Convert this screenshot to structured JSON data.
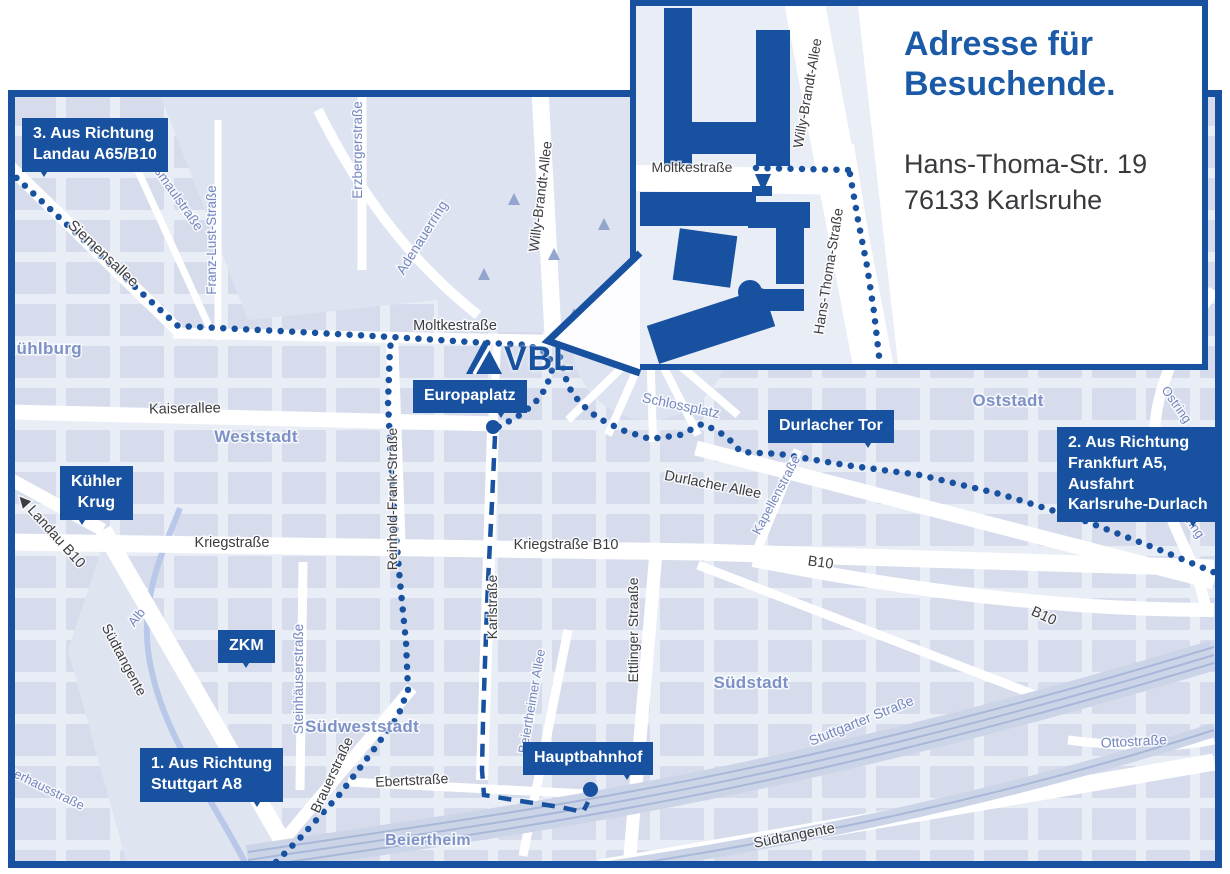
{
  "colors": {
    "primary_blue": "#17519f",
    "map_background": "#e9edf6",
    "block_fill": "#d6dcec",
    "street_white": "#ffffff",
    "label_dark": "#3d3d40",
    "label_blue": "#7488bf",
    "area_label_blue": "#7d91c6",
    "river_blue": "#b9c8e8",
    "rail_gray_blue": "#a9b7d8"
  },
  "logo": {
    "text": "VBL",
    "icon": "vbl-triangle-icon"
  },
  "inset": {
    "title_line1": "Adresse für",
    "title_line2": "Besuchende.",
    "address_line1": "Hans-Thoma-Str. 19",
    "address_line2": "76133 Karlsruhe",
    "street_labels": [
      {
        "text": "Moltkestraße",
        "x": 56,
        "y": 166,
        "r": 0
      },
      {
        "text": "Willy-Brandt-Allee",
        "x": 176,
        "y": 88,
        "r": -80
      },
      {
        "text": "Hans-Thoma-Straße",
        "x": 197,
        "y": 266,
        "r": -81
      }
    ],
    "route_dotted": [
      [
        [
          120,
          162
        ],
        [
          213,
          164
        ]
      ],
      [
        [
          214,
          168
        ],
        [
          222,
          214
        ],
        [
          231,
          260
        ],
        [
          238,
          306
        ],
        [
          243,
          350
        ]
      ]
    ]
  },
  "signs": [
    {
      "id": "landau",
      "x": 22,
      "y": 118,
      "lines": [
        "3. Aus Richtung",
        "Landau A65/B10"
      ],
      "tail": "left"
    },
    {
      "id": "kuehler-krug",
      "x": 60,
      "y": 466,
      "lines": [
        "Kühler",
        "Krug"
      ],
      "tail": "left",
      "align": "center"
    },
    {
      "id": "zkm",
      "x": 218,
      "y": 630,
      "lines": [
        "ZKM"
      ],
      "tail": "center"
    },
    {
      "id": "stuttgart",
      "x": 140,
      "y": 748,
      "lines": [
        "1. Aus Richtung",
        "Stuttgart A8"
      ],
      "tail": "right"
    },
    {
      "id": "europaplatz",
      "x": 413,
      "y": 380,
      "lines": [
        "Europaplatz"
      ],
      "tail": "right",
      "dot": [
        493,
        427
      ]
    },
    {
      "id": "durlacher-tor",
      "x": 768,
      "y": 410,
      "lines": [
        "Durlacher Tor"
      ],
      "tail": "right"
    },
    {
      "id": "frankfurt",
      "x": 1057,
      "y": 427,
      "lines": [
        "2. Aus Richtung",
        "Frankfurt A5,",
        "Ausfahrt",
        "Karlsruhe-Durlach"
      ],
      "tail": "right"
    },
    {
      "id": "hauptbahnhof",
      "x": 523,
      "y": 742,
      "lines": [
        "Hauptbahnhof"
      ],
      "tail": "right",
      "dot": [
        590,
        789
      ]
    }
  ],
  "map": {
    "street_labels": [
      {
        "text": "Siemensallee",
        "x": 92,
        "y": 167,
        "r": 43,
        "c": "dark",
        "s": 15
      },
      {
        "text": "Kußmaulstraße",
        "x": 162,
        "y": 104,
        "r": 55,
        "c": "blue",
        "s": 13.5
      },
      {
        "text": "Franz-Lust-Straße",
        "x": 208,
        "y": 150,
        "r": -90,
        "c": "blue",
        "s": 13.5
      },
      {
        "text": "Erzbergerstraße",
        "x": 354,
        "y": 60,
        "r": -90,
        "c": "blue",
        "s": 13.5
      },
      {
        "text": "Mühlburg",
        "x": 34,
        "y": 264,
        "r": 0,
        "c": "area",
        "s": 17
      },
      {
        "text": "Adenauerring",
        "x": 418,
        "y": 150,
        "r": -58,
        "c": "blue",
        "s": 14
      },
      {
        "text": "Willy-Brandt-Allee",
        "x": 537,
        "y": 107,
        "r": -83,
        "c": "dark",
        "s": 14
      },
      {
        "text": "Moltkestraße",
        "x": 447,
        "y": 240,
        "r": 0,
        "c": "dark",
        "s": 14.5
      },
      {
        "text": "Kaiserallee",
        "x": 177,
        "y": 323,
        "r": -1,
        "c": "dark",
        "s": 14.5
      },
      {
        "text": "Weststadt",
        "x": 248,
        "y": 352,
        "r": 0,
        "c": "area",
        "s": 17
      },
      {
        "text": "Schlossplatz",
        "x": 672,
        "y": 320,
        "r": 12,
        "c": "blue",
        "s": 14
      },
      {
        "text": "Oststadt",
        "x": 1000,
        "y": 316,
        "r": 0,
        "c": "area",
        "s": 17
      },
      {
        "text": "Reinhold-Frank-Straße",
        "x": 389,
        "y": 409,
        "r": -90,
        "c": "dark",
        "s": 14
      },
      {
        "text": "Kriegstraße",
        "x": 224,
        "y": 457,
        "r": 0,
        "c": "dark",
        "s": 14.5
      },
      {
        "text": "Kriegstraße B10",
        "x": 558,
        "y": 459,
        "r": 0,
        "c": "dark",
        "s": 14.5
      },
      {
        "text": "Durlacher Allee",
        "x": 704,
        "y": 399,
        "r": 11,
        "c": "dark",
        "s": 14.5
      },
      {
        "text": "Kapellenstraße",
        "x": 772,
        "y": 407,
        "r": -62,
        "c": "blue",
        "s": 13
      },
      {
        "text": "Ostring",
        "x": 1165,
        "y": 317,
        "r": 55,
        "c": "blue",
        "s": 13
      },
      {
        "text": "Ostring",
        "x": 1178,
        "y": 432,
        "r": 55,
        "c": "blue",
        "s": 13
      },
      {
        "text": "B10",
        "x": 812,
        "y": 477,
        "r": 8,
        "c": "dark",
        "s": 14.5
      },
      {
        "text": "B10",
        "x": 1034,
        "y": 530,
        "r": 25,
        "c": "dark",
        "s": 14.5
      },
      {
        "text": "◀ Landau B10",
        "x": 40,
        "y": 444,
        "r": 48,
        "c": "dark",
        "s": 14.5
      },
      {
        "text": "Karlstraße",
        "x": 489,
        "y": 517,
        "r": -90,
        "c": "dark",
        "s": 14
      },
      {
        "text": "Ettlinger Straaße",
        "x": 630,
        "y": 540,
        "r": -90,
        "c": "dark",
        "s": 14
      },
      {
        "text": "Steinhäuserstraße",
        "x": 295,
        "y": 589,
        "r": -90,
        "c": "blue",
        "s": 13.5
      },
      {
        "text": "Südweststadt",
        "x": 354,
        "y": 642,
        "r": 0,
        "c": "area",
        "s": 17
      },
      {
        "text": "Südstadt",
        "x": 743,
        "y": 598,
        "r": 0,
        "c": "area",
        "s": 17
      },
      {
        "text": "Stuttgarter Straße",
        "x": 855,
        "y": 635,
        "r": -22,
        "c": "blue",
        "s": 14
      },
      {
        "text": "Südtangente",
        "x": 112,
        "y": 572,
        "r": 62,
        "c": "dark",
        "s": 14
      },
      {
        "text": "Südtangente",
        "x": 787,
        "y": 750,
        "r": -11,
        "c": "dark",
        "s": 14.5
      },
      {
        "text": "Alb",
        "x": 132,
        "y": 530,
        "r": -52,
        "c": "blue",
        "s": 13
      },
      {
        "text": "Pulverhausstraße",
        "x": 28,
        "y": 698,
        "r": 26,
        "c": "blue",
        "s": 13
      },
      {
        "text": "Ottostraße",
        "x": 1126,
        "y": 656,
        "r": -3,
        "c": "blue",
        "s": 14
      },
      {
        "text": "Brauerstraße",
        "x": 328,
        "y": 687,
        "r": -65,
        "c": "dark",
        "s": 14
      },
      {
        "text": "Ebertstraße",
        "x": 404,
        "y": 695,
        "r": -3,
        "c": "dark",
        "s": 14
      },
      {
        "text": "Beiertheimer Allee",
        "x": 528,
        "y": 612,
        "r": -80,
        "c": "blue",
        "s": 13
      },
      {
        "text": "Beiertheim",
        "x": 420,
        "y": 755,
        "r": 0,
        "c": "area",
        "s": 16
      }
    ],
    "routes": {
      "dotted": [
        [
          [
            0,
            80
          ],
          [
            82,
            156
          ],
          [
            170,
            236
          ],
          [
            292,
            242
          ],
          [
            384,
            247
          ],
          [
            462,
            252
          ],
          [
            520,
            255
          ],
          [
            541,
            264
          ],
          [
            544,
            280
          ],
          [
            538,
            298
          ],
          [
            526,
            314
          ],
          [
            509,
            327
          ],
          [
            492,
            336
          ],
          [
            485,
            340
          ]
        ],
        [
          [
            552,
            267
          ],
          [
            560,
            296
          ],
          [
            572,
            313
          ],
          [
            590,
            328
          ],
          [
            614,
            340
          ],
          [
            642,
            349
          ],
          [
            672,
            345
          ],
          [
            694,
            334
          ],
          [
            708,
            340
          ],
          [
            720,
            348
          ],
          [
            733,
            362
          ],
          [
            772,
            364
          ],
          [
            837,
            375
          ],
          [
            912,
            385
          ],
          [
            992,
            404
          ],
          [
            1072,
            429
          ],
          [
            1152,
            460
          ],
          [
            1210,
            484
          ]
        ],
        [
          [
            260,
            780
          ],
          [
            292,
            748
          ],
          [
            332,
            704
          ],
          [
            364,
            662
          ],
          [
            390,
            626
          ],
          [
            400,
            600
          ],
          [
            398,
            552
          ],
          [
            392,
            492
          ],
          [
            387,
            432
          ],
          [
            383,
            372
          ],
          [
            380,
            312
          ],
          [
            382,
            257
          ],
          [
            385,
            248
          ]
        ]
      ],
      "dashed": [
        [
          [
            487,
            346
          ],
          [
            484,
            412
          ],
          [
            480,
            492
          ],
          [
            477,
            572
          ],
          [
            475,
            632
          ],
          [
            474,
            680
          ],
          [
            476,
            705
          ],
          [
            512,
            711
          ],
          [
            552,
            717
          ],
          [
            575,
            722
          ],
          [
            580,
            712
          ]
        ]
      ]
    },
    "markers": [
      {
        "name": "europaplatz-stop",
        "x": 493,
        "y": 427,
        "d": 14
      },
      {
        "name": "hauptbahnhof-stop",
        "x": 590,
        "y": 789,
        "d": 15
      }
    ]
  }
}
